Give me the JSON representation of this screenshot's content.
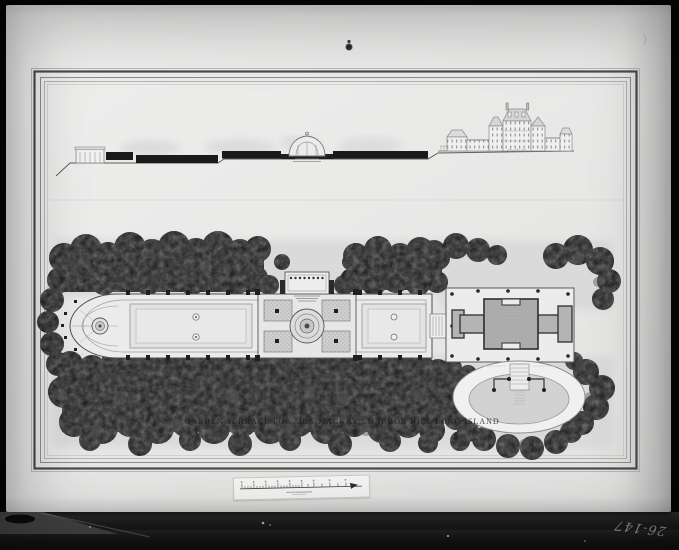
{
  "photo": {
    "plate_number": "26-147"
  },
  "sheet": {
    "title": "GARDEN TERRACE FOR MRS·MACKAY : HARBOR HILL LONG ISLAND"
  },
  "colors": {
    "frame_black": "#060606",
    "board_gray": "#e9e9e8",
    "foliage_dark": "#212121",
    "ink_gray": "#4a4a4a",
    "roof_gray": "#aeaeae"
  }
}
